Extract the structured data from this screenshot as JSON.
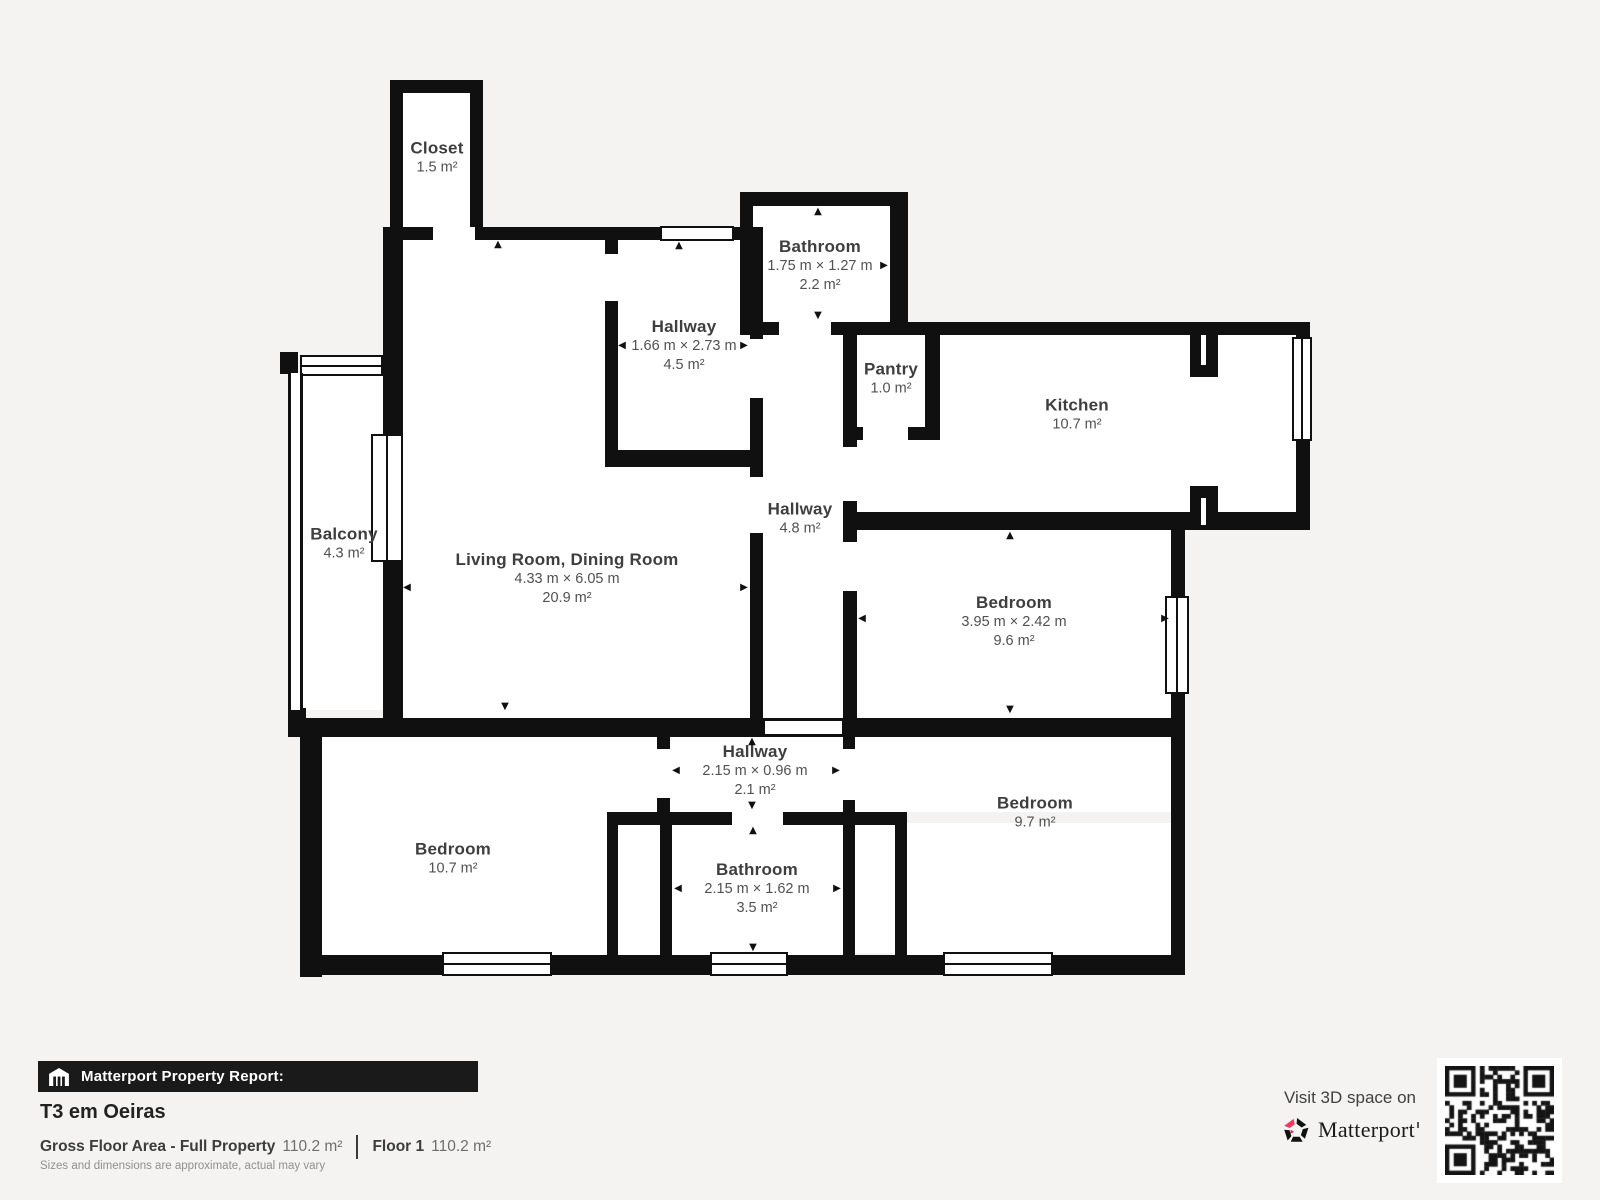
{
  "colors": {
    "wall": "#101010",
    "background": "#f4f3f1",
    "brand_red": "#f5365f"
  },
  "icons": {
    "up": "▲",
    "down": "▼",
    "left": "◀",
    "right": "▶"
  },
  "rooms": [
    {
      "name": "Closet",
      "area": "1.5 m²"
    },
    {
      "name": "Hallway",
      "dims": "1.66 m × 2.73 m",
      "area": "4.5 m²"
    },
    {
      "name": "Bathroom",
      "dims": "1.75 m × 1.27 m",
      "area": "2.2 m²"
    },
    {
      "name": "Pantry",
      "area": "1.0 m²"
    },
    {
      "name": "Kitchen",
      "area": "10.7 m²"
    },
    {
      "name": "Balcony",
      "area": "4.3 m²"
    },
    {
      "name": "Living Room, Dining Room",
      "dims": "4.33 m × 6.05 m",
      "area": "20.9 m²"
    },
    {
      "name": "Hallway",
      "area": "4.8 m²"
    },
    {
      "name": "Bedroom",
      "dims": "3.95 m × 2.42 m",
      "area": "9.6 m²"
    },
    {
      "name": "Bedroom",
      "area": "10.7 m²"
    },
    {
      "name": "Hallway",
      "dims": "2.15 m × 0.96 m",
      "area": "2.1 m²"
    },
    {
      "name": "Bathroom",
      "dims": "2.15 m × 1.62 m",
      "area": "3.5 m²"
    },
    {
      "name": "Bedroom",
      "area": "9.7 m²"
    }
  ],
  "footer": {
    "report_label": "Matterport Property Report:",
    "property_title": "T3 em Oeiras",
    "gross_area_label": "Gross Floor Area - Full Property",
    "gross_area_value": "110.2 m²",
    "floor_label": "Floor 1",
    "floor_value": "110.2 m²",
    "disclaimer": "Sizes and dimensions are approximate, actual may vary",
    "visit_text": "Visit 3D space on",
    "brand_name": "Matterport"
  }
}
